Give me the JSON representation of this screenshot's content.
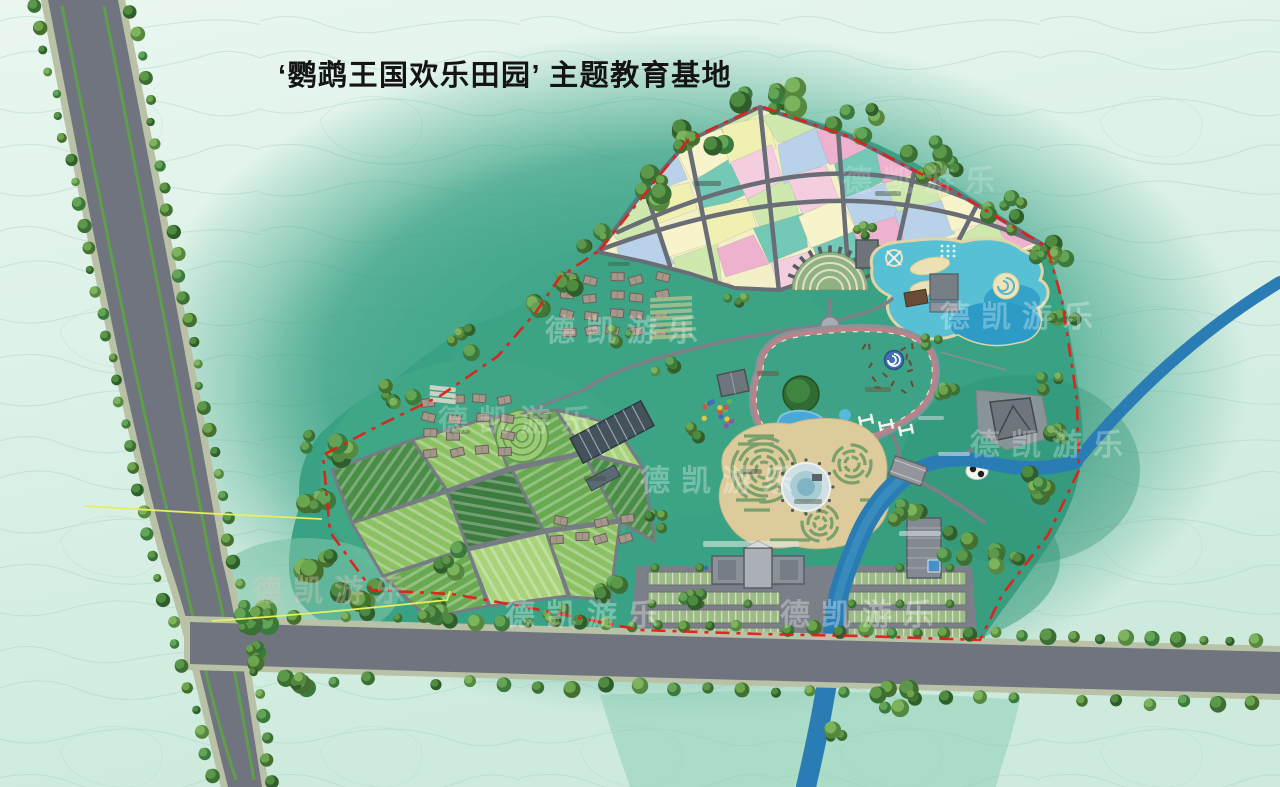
{
  "title": {
    "text": "‘鹦鹉王国欢乐田园’ 主题教育基地"
  },
  "watermark": {
    "text": "德凯游乐"
  },
  "palette": {
    "background_top": "#e9f7f0",
    "background_bottom": "#cdeadd",
    "contour_line": "#a6cbbd",
    "park_green": "#3aa284",
    "halo_green": "#35a083",
    "road_gray": "#70747e",
    "road_verge": "#b9c2a6",
    "lane_line_green": "#5f9e4d",
    "river_blue": "#2a7db4",
    "boundary_red": "#e02018",
    "boundary_yellow": "#e6ef5e",
    "sand": "#e5cfa3",
    "maze_sand": "#ddcb9b",
    "hedge_green": "#7aa06b",
    "pond_cyan": "#57c0d4",
    "pond_deep": "#2d9bc5",
    "track_pink": "#bb8289",
    "building_gray": "#8b9199",
    "village_tan": "#a5978a",
    "plot_colors": [
      "#eeb2ce",
      "#f4cede",
      "#f0f0b2",
      "#b9d2e9",
      "#74c8b6",
      "#cfe8ad",
      "#f7f3cb"
    ],
    "field_greens": [
      "#4a8d45",
      "#69aa50",
      "#8cc163",
      "#a9d37a",
      "#3d7b3e"
    ],
    "watermark_white": "rgba(255,255,255,0.30)"
  }
}
